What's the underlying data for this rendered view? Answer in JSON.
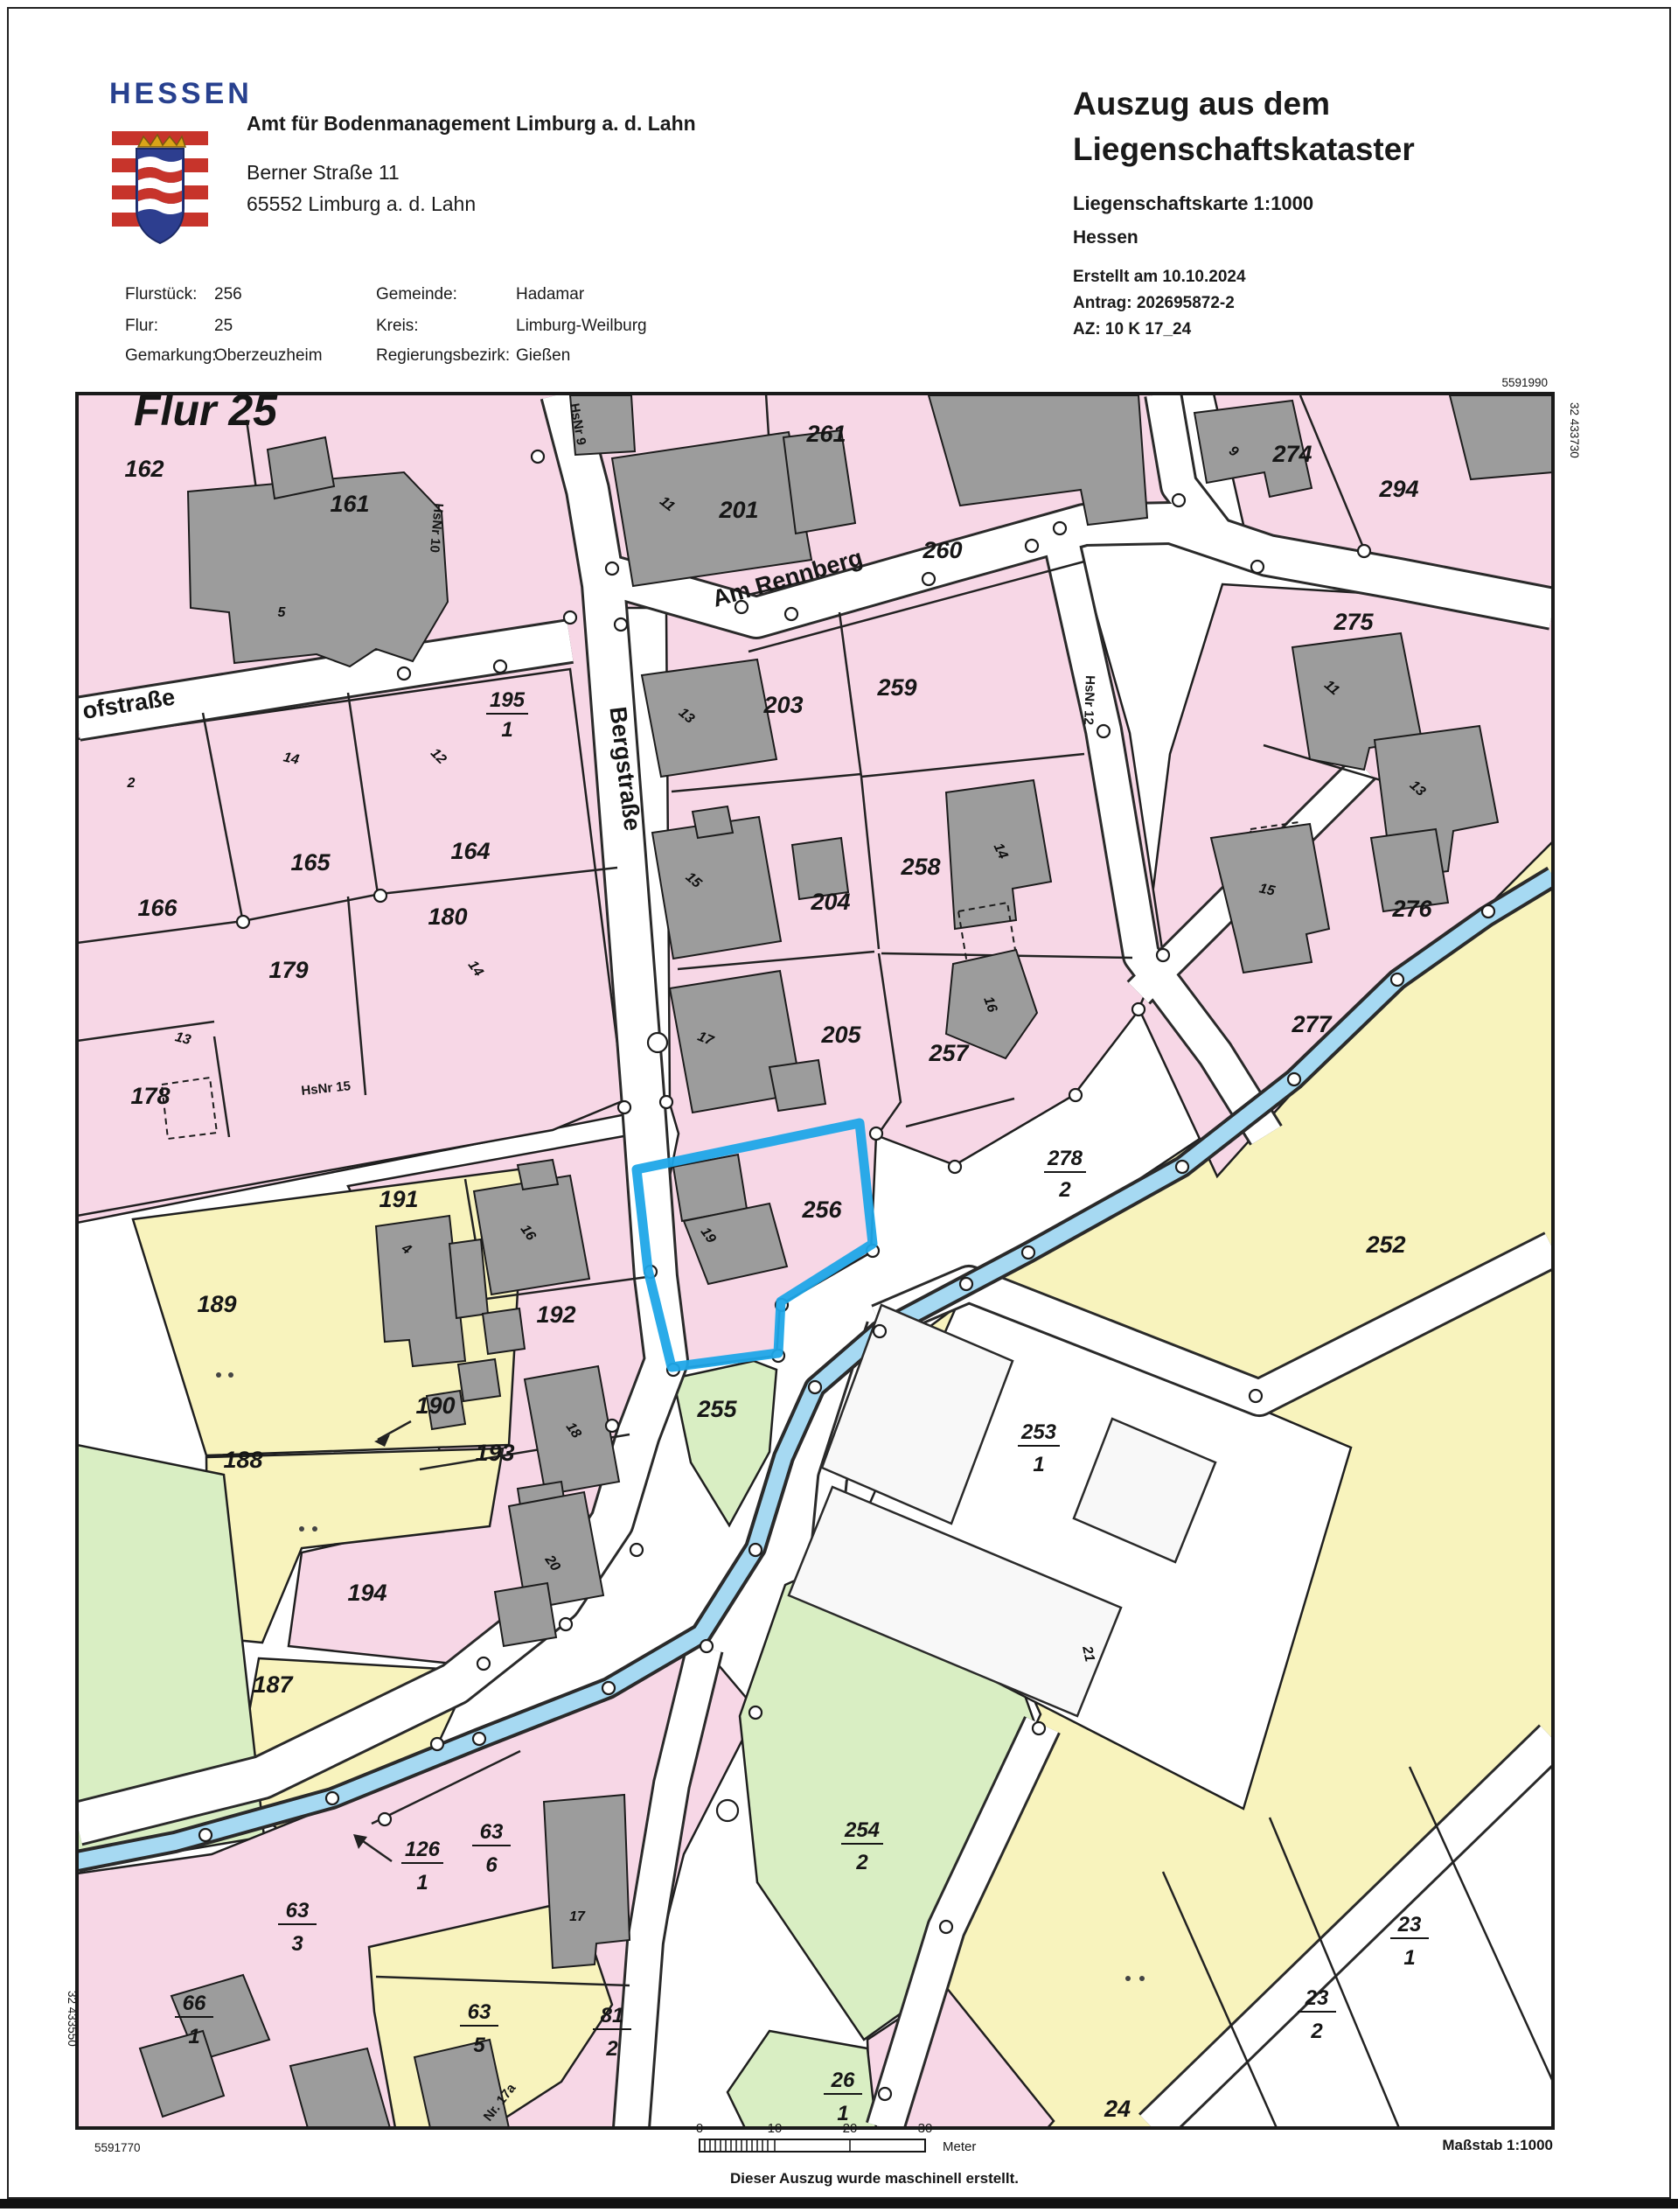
{
  "header": {
    "wordmark": "HESSEN",
    "office": "Amt für Bodenmanagement Limburg a. d. Lahn",
    "address_line1": "Berner Straße 11",
    "address_line2": "65552 Limburg a. d. Lahn",
    "title_line1": "Auszug aus dem",
    "title_line2": "Liegenschaftskataster",
    "subtitle": "Liegenschaftskarte 1:1000",
    "region": "Hessen",
    "created": "Erstellt am 10.10.2024",
    "antrag": "Antrag: 202695872-2",
    "az": "AZ: 10 K 17_24"
  },
  "meta": {
    "flurstueck_label": "Flurstück:",
    "flurstueck": "256",
    "flur_label": "Flur:",
    "flur": "25",
    "gemarkung_label": "Gemarkung:",
    "gemarkung": "Oberzeuzheim",
    "gemeinde_label": "Gemeinde:",
    "gemeinde": "Hadamar",
    "kreis_label": "Kreis:",
    "kreis": "Limburg-Weilburg",
    "bezirk_label": "Regierungsbezirk:",
    "bezirk": "Gießen"
  },
  "map": {
    "flur_title": "Flur 25",
    "coords": {
      "top_right": "5591990",
      "right_top": "32 433730",
      "bottom_left": "5591770",
      "left_bottom": "32 433550"
    },
    "streets": {
      "am_rennberg": "Am Rennberg",
      "bergstrasse": "Bergstraße",
      "ofstrasse": "ofstraße",
      "hsnr9": "HsNr 9",
      "hsnr10": "HsNr 10",
      "hsnr12": "HsNr 12",
      "hsnr15": "HsNr 15",
      "nr17a": "Nr. 17a"
    },
    "parcels": {
      "p162": "162",
      "p161": "161",
      "p201": "201",
      "p261": "261",
      "p260": "260",
      "p274": "274",
      "p294": "294",
      "p275": "275",
      "p276": "276",
      "p277": "277",
      "p203": "203",
      "p259": "259",
      "p204": "204",
      "p258": "258",
      "p205": "205",
      "p257": "257",
      "p165": "165",
      "p164": "164",
      "p166": "166",
      "p180": "180",
      "p179": "179",
      "p178": "178",
      "p191": "191",
      "p192": "192",
      "p190": "190",
      "p193": "193",
      "p194": "194",
      "p189": "189",
      "p188": "188",
      "p187": "187",
      "p256": "256",
      "p255": "255",
      "p252": "252",
      "p24": "24"
    },
    "fractions": {
      "p195": {
        "n": "195",
        "d": "1"
      },
      "p278": {
        "n": "278",
        "d": "2"
      },
      "p253": {
        "n": "253",
        "d": "1"
      },
      "p254": {
        "n": "254",
        "d": "2"
      },
      "p126": {
        "n": "126",
        "d": "1"
      },
      "p63_6": {
        "n": "63",
        "d": "6"
      },
      "p63_3": {
        "n": "63",
        "d": "3"
      },
      "p63_5": {
        "n": "63",
        "d": "5"
      },
      "p66": {
        "n": "66",
        "d": "1"
      },
      "p81": {
        "n": "81",
        "d": "2"
      },
      "p26": {
        "n": "26",
        "d": "1"
      },
      "p23_1": {
        "n": "23",
        "d": "1"
      },
      "p23_2": {
        "n": "23",
        "d": "2"
      }
    },
    "buildings": {
      "b162": "5",
      "b201": "11",
      "b274": "9",
      "b275": "11",
      "b276": "13",
      "b277": "15",
      "b203": "13",
      "b204": "15",
      "b205": "17",
      "b258": "14",
      "b257": "16",
      "b164": "12",
      "b165": "14",
      "b166": "2",
      "b178": "13",
      "b180": "14",
      "b256": "19",
      "b191": "4",
      "b192": "16",
      "b193": "18",
      "b194": "20",
      "b63_6": "17",
      "b253": "21"
    },
    "colors": {
      "parcel_pink": "#f7d7e6",
      "parcel_yellow": "#f8f3bd",
      "parcel_green": "#d9eec3",
      "water_blue": "#a6d9f2",
      "building_gray": "#9c9c9c",
      "highlight_blue": "#1fa6e8"
    }
  },
  "footer": {
    "massstab": "Maßstab 1:1000",
    "ticks": [
      "0",
      "10",
      "20",
      "30"
    ],
    "unit": "Meter",
    "note": "Dieser Auszug wurde maschinell erstellt."
  }
}
